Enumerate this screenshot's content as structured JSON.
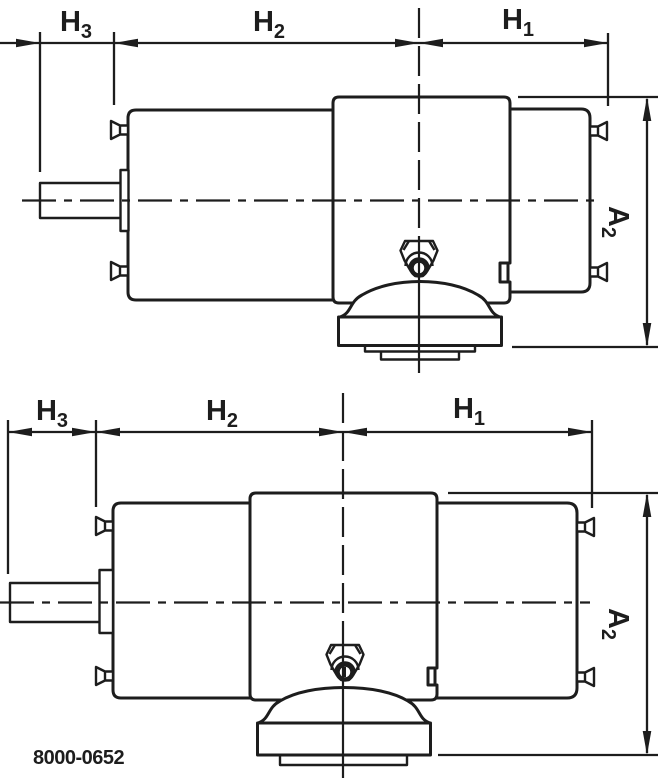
{
  "drawing": {
    "background_color": "#ffffff",
    "line_color": "#1d1d1d",
    "drawing_number": "8000-0652",
    "views": [
      {
        "name": "gear-motor-side-view-short-shaft",
        "dim_h3": {
          "base": "H",
          "sub": "3"
        },
        "dim_h2": {
          "base": "H",
          "sub": "2"
        },
        "dim_h1": {
          "base": "H",
          "sub": "1"
        },
        "dim_a2": {
          "base": "A",
          "sub": "2"
        }
      },
      {
        "name": "gear-motor-side-view-long-shaft",
        "dim_h3": {
          "base": "H",
          "sub": "3"
        },
        "dim_h2": {
          "base": "H",
          "sub": "2"
        },
        "dim_h1": {
          "base": "H",
          "sub": "1"
        },
        "dim_a2": {
          "base": "A",
          "sub": "2"
        }
      }
    ]
  }
}
